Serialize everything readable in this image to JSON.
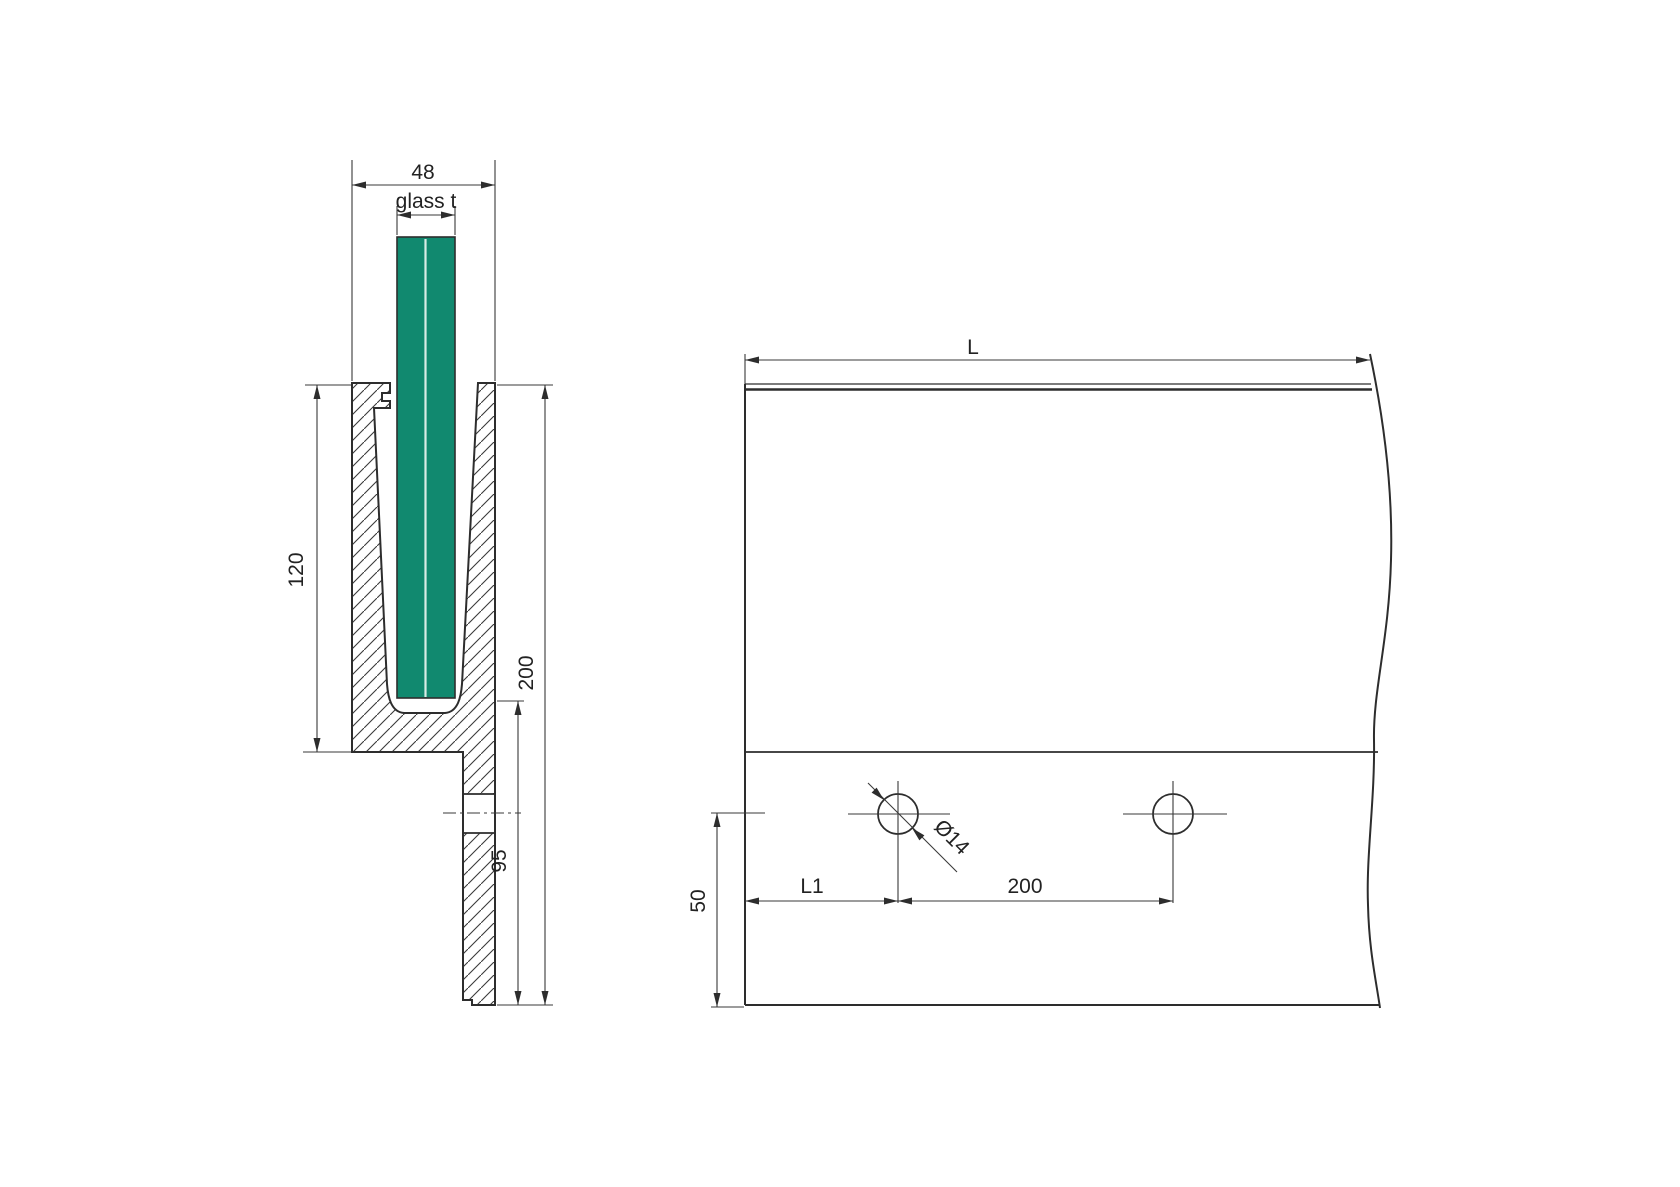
{
  "drawing": {
    "type": "technical-drawing",
    "subject": "glass balustrade base channel profile - section and elevation",
    "section_view": {
      "profile_width_dim": "48",
      "glass_thickness_dim": "glass t",
      "channel_depth_dim": "120",
      "total_height_dim": "200",
      "hole_axis_to_bottom_dim": "95"
    },
    "elevation_view": {
      "length_dim": "L",
      "end_offset_dim": "L1",
      "hole_spacing_dim": "200",
      "hole_axis_height_dim": "50",
      "hole_diameter_dim": "Ø14"
    },
    "colors": {
      "glass_fill": "#11896F",
      "glass_interlayer": "#D8ECE5",
      "line_color": "#2D2D2D",
      "background": "#FFFFFF"
    }
  }
}
